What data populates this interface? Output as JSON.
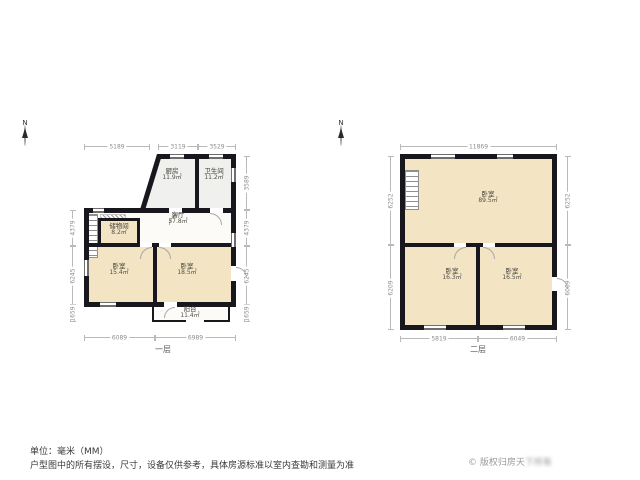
{
  "colors": {
    "wall": "#17171d",
    "room_cream": "#f3e4c4",
    "room_gray": "#f0f0ee",
    "room_white": "#fcfbf7"
  },
  "north_letter": "N",
  "floor1": {
    "label": "一层",
    "rooms": [
      {
        "name": "厨房",
        "area": "11.9㎡"
      },
      {
        "name": "卫生间",
        "area": "11.2㎡"
      },
      {
        "name": "客厅",
        "area": "57.8㎡"
      },
      {
        "name": "储物间",
        "area": "8.2㎡"
      },
      {
        "name": "卧室",
        "area": "15.4㎡"
      },
      {
        "name": "卧室",
        "area": "18.5㎡"
      },
      {
        "name": "阳台",
        "area": "11.4㎡"
      }
    ],
    "dims_top": [
      "5189",
      "3119",
      "3529"
    ],
    "dims_bottom": [
      "6089",
      "6989"
    ],
    "dims_left": [
      "4379",
      "6245",
      "1659"
    ],
    "dims_right": [
      "3589",
      "4379",
      "6245",
      "1659"
    ]
  },
  "floor2": {
    "label": "二层",
    "rooms": [
      {
        "name": "卧室",
        "area": "89.5㎡"
      },
      {
        "name": "卧室",
        "area": "16.3㎡"
      },
      {
        "name": "卧室",
        "area": "16.5㎡"
      }
    ],
    "dims_top": [
      "11869"
    ],
    "dims_bottom": [
      "5819",
      "6049"
    ],
    "dims_left": [
      "6252",
      "6209"
    ],
    "dims_right": [
      "6252",
      "6009"
    ]
  },
  "footer": {
    "unit_note": "单位：毫米（MM）",
    "disclaimer": "户型图中的所有摆设，尺寸，设备仅供参考，具体房源标准以室内查勘和测量为准",
    "copyright_icon": "©",
    "copyright_visible": " 版权归房天",
    "copyright_blurred": "下所有"
  }
}
